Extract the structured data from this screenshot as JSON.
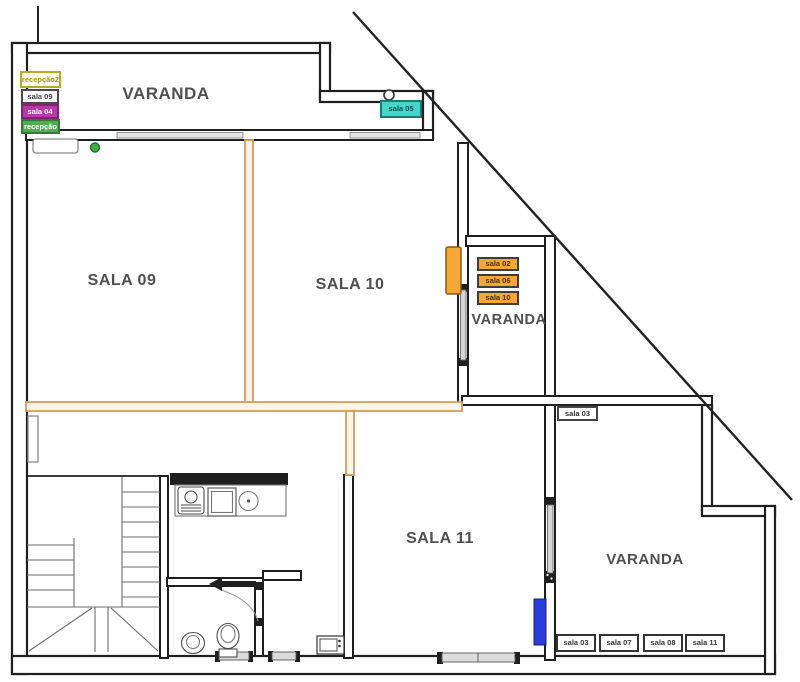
{
  "plan": {
    "title": "floor-plan",
    "legend_tags": [
      {
        "label": "recepção2",
        "bg": "#fffdf0",
        "border": "#b9ab25",
        "text_color": "#a29818"
      },
      {
        "label": "sala 09",
        "bg": "#ffffff",
        "border": "#4a4a4a",
        "text_color": "#3f3f3f"
      },
      {
        "label": "sala 04",
        "bg": "#b93aa6",
        "border": "#7e2470",
        "text_color": "#ffffff"
      },
      {
        "label": "recepção",
        "bg": "#4cae50",
        "border": "#2e7d32",
        "text_color": "#ffffff"
      }
    ],
    "room_labels": {
      "varanda_top": "VARANDA",
      "sala09": "SALA 09",
      "sala10": "SALA 10",
      "sala11": "SALA 11",
      "varanda_right": "VARANDA",
      "varanda_bottom": "VARANDA"
    },
    "teal_tag": {
      "label": "sala 05",
      "bg": "#43d6c9",
      "border": "#1a7d74"
    },
    "orange_tags": [
      {
        "label": "sala 02"
      },
      {
        "label": "sala 06"
      },
      {
        "label": "sala 10"
      }
    ],
    "orange_tag_style": {
      "bg": "#f5a733",
      "border": "#3d3d3d"
    },
    "mid_tag": {
      "label": "sala 03"
    },
    "bottom_tags": [
      {
        "label": "sala 03"
      },
      {
        "label": "sala 07"
      },
      {
        "label": "sala 08"
      },
      {
        "label": "sala 11"
      }
    ],
    "markers": {
      "blue_marker_color": "#2b3cdb",
      "orange_door_marker_color": "#f5a733",
      "green_dot_color": "#3fae46"
    },
    "colors": {
      "wall": "#1f1f1f",
      "orange_wall": "#d69a5b",
      "window_fill": "#dcdcdc"
    }
  }
}
